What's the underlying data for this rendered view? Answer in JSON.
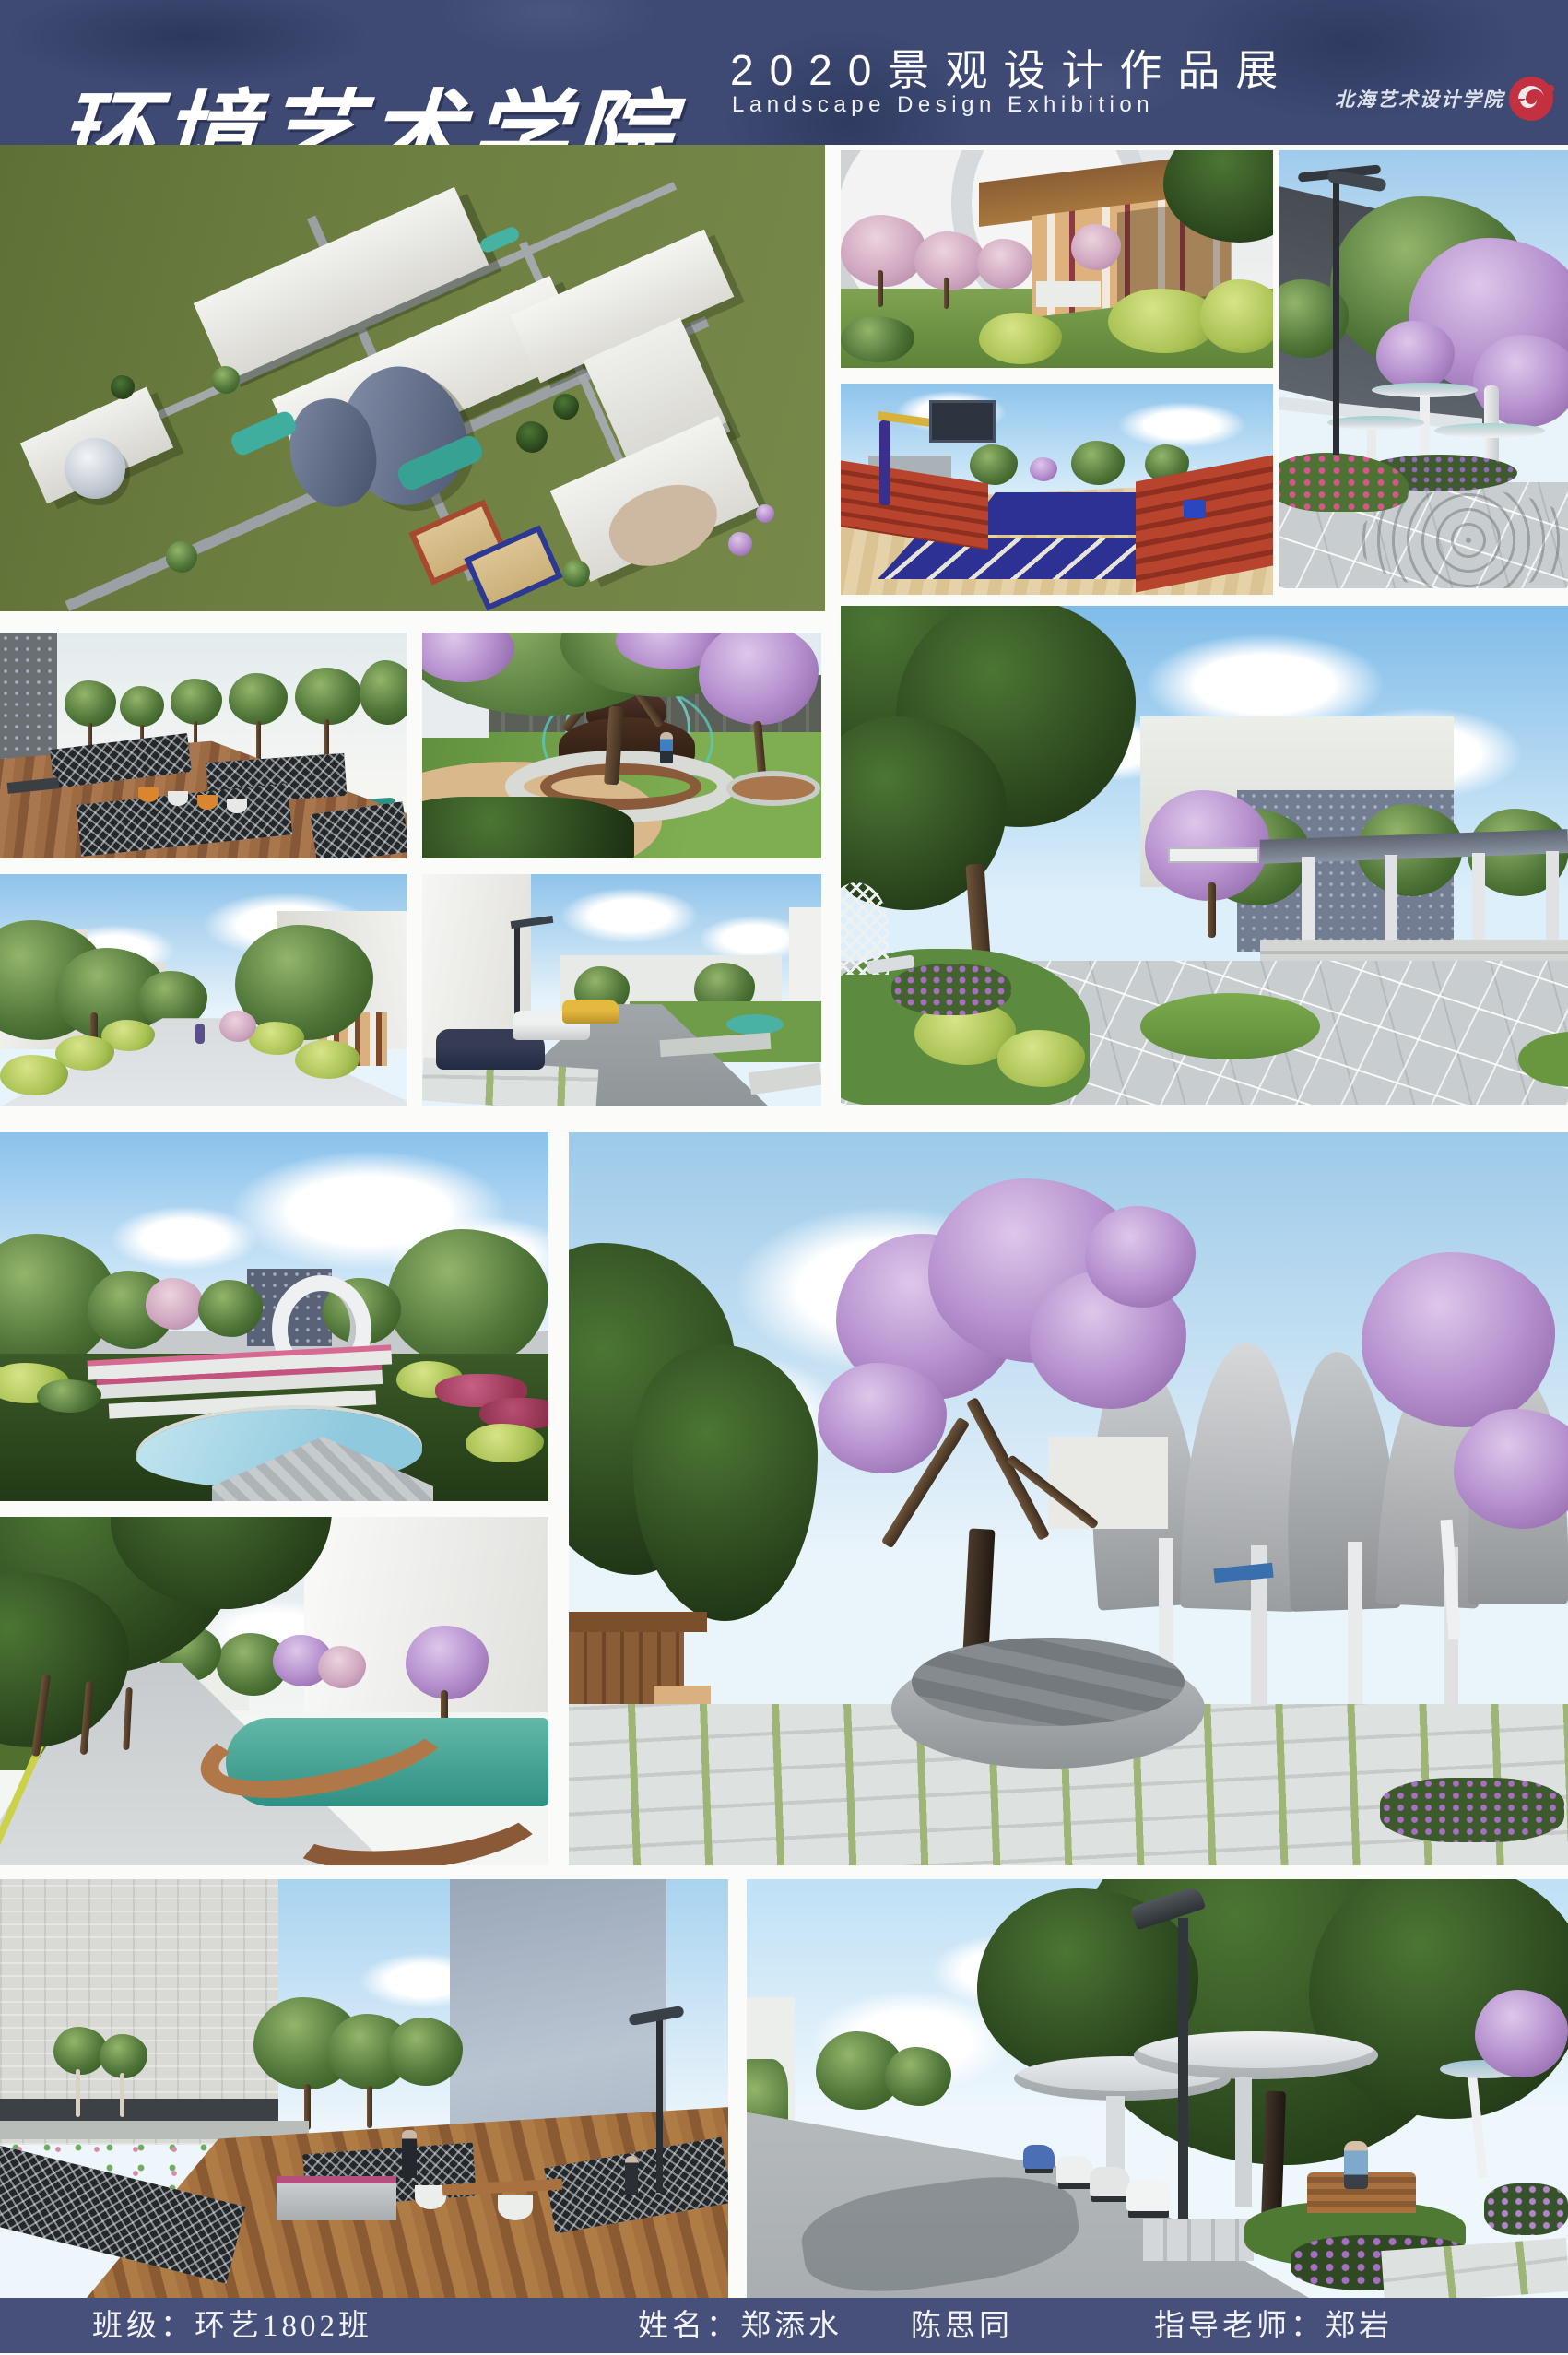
{
  "header": {
    "title": "环境艺术学院",
    "subtitle_cn": "2020景观设计作品展",
    "subtitle_en": "Landscape Design Exhibition",
    "logo_text": "北海艺术设计学院"
  },
  "footer": {
    "class_label": "班级：环艺1802班",
    "names_label": "姓名：郑添水　　陈思同",
    "advisor_label": "指导老师：郑岩"
  },
  "colors": {
    "header_bg": "#3e4a73",
    "footer_bg": "#47507a",
    "gutter": "#fbfbfa",
    "logo_red": "#c3303f",
    "masterplan_field": "#6c7d3f"
  },
  "gallery": {
    "panels": [
      {
        "alt": "Aerial campus masterplan render"
      },
      {
        "alt": "Timber pergola corridor with blossom trees"
      },
      {
        "alt": "Outdoor basketball court with red bleachers"
      },
      {
        "alt": "Plaza with street lamp and white canopy trees"
      },
      {
        "alt": "Wooden boardwalk with ponds and lattice fences"
      },
      {
        "alt": "Tiered fountain under blossom tree"
      },
      {
        "alt": "Tree-lined campus street"
      },
      {
        "alt": "Courtyard road with parked cars"
      },
      {
        "alt": "Stone plaza with long pergola canopy"
      },
      {
        "alt": "Park with ring sculpture and pool"
      },
      {
        "alt": "Blossom tree and concrete petal pavilion"
      },
      {
        "alt": "Pool promenade with tree-lined path"
      },
      {
        "alt": "Wooden deck terrace with lotus pond"
      },
      {
        "alt": "Plaza with round canopies and scooters"
      }
    ]
  }
}
